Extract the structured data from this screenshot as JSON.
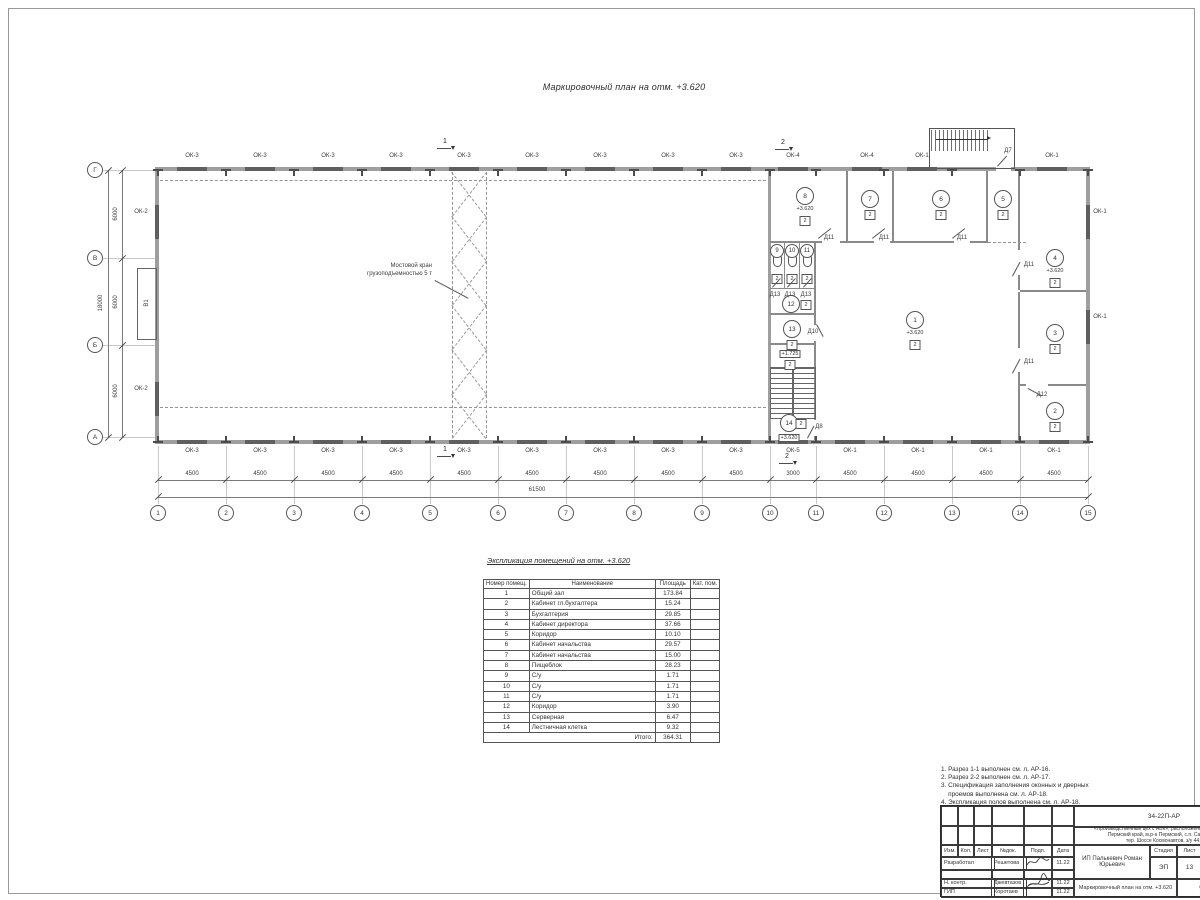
{
  "page_title": "Маркировочный план  на отм. +3.620",
  "plan": {
    "axes_bottom": [
      "1",
      "2",
      "3",
      "4",
      "5",
      "6",
      "7",
      "8",
      "9",
      "10",
      "11",
      "12",
      "13",
      "14",
      "15"
    ],
    "axes_left": [
      "Г",
      "В",
      "Б",
      "А"
    ],
    "dims_bottom": [
      "4500",
      "4500",
      "4500",
      "4500",
      "4500",
      "4500",
      "4500",
      "4500",
      "4500",
      "3000",
      "4500",
      "4500",
      "4500",
      "4500"
    ],
    "dim_bottom_total": "61500",
    "dims_left": [
      "6000",
      "6000",
      "6000"
    ],
    "dim_left_total": "18000",
    "windows_top": [
      "ОК-3",
      "ОК-3",
      "ОК-3",
      "ОК-3",
      "ОК-3",
      "ОК-3",
      "ОК-3",
      "ОК-3",
      "ОК-3",
      "ОК-4",
      "ОК-4",
      "ОК-1",
      "ОК-1"
    ],
    "windows_bottom": [
      "ОК-3",
      "ОК-3",
      "ОК-3",
      "ОК-3",
      "ОК-3",
      "ОК-3",
      "ОК-3",
      "ОК-3",
      "ОК-3",
      "ОК-5",
      "ОК-1",
      "ОК-1",
      "ОК-1",
      "ОК-1"
    ],
    "windows_left": [
      "ОК-2",
      "ОК-2"
    ],
    "windows_right": [
      "ОК-1",
      "ОК-1"
    ],
    "gate_label": "В1",
    "crane_note_line1": "Мостовой кран",
    "crane_note_line2": "грузоподъемностью 5 т",
    "section_marks": [
      "1",
      "2",
      "1",
      "2"
    ],
    "rooms": [
      {
        "num": "8",
        "level": "+3.620",
        "kat": "2"
      },
      {
        "num": "7",
        "kat": "2"
      },
      {
        "num": "6",
        "kat": "2"
      },
      {
        "num": "5",
        "kat": "2"
      },
      {
        "num": "4",
        "level": "+3.620",
        "kat": "2"
      },
      {
        "num": "9"
      },
      {
        "num": "10"
      },
      {
        "num": "11"
      },
      {
        "num": "12",
        "kat": "2"
      },
      {
        "num": "13",
        "kat": "2"
      },
      {
        "num": "1",
        "level": "+3.620",
        "kat": "2"
      },
      {
        "num": "3",
        "kat": "2"
      },
      {
        "num": "2",
        "kat": "2"
      },
      {
        "num": "14",
        "kat": "2",
        "level_boxed": "+3.620"
      }
    ],
    "wc_kats": [
      "2",
      "2",
      "2"
    ],
    "landing_level_boxed": "+1.725",
    "landing_kat": "2",
    "doors": [
      "Д11",
      "Д11",
      "Д11",
      "Д11",
      "Д11",
      "Д12",
      "Д13",
      "Д13",
      "Д13",
      "Д10",
      "Д8",
      "Д7"
    ]
  },
  "explication": {
    "title": "Экспликация помещений на отм. +3.620",
    "headers": {
      "num": "Номер помещ.",
      "name": "Наименование",
      "area": "Площадь",
      "kat": "Кат. пом."
    },
    "rows": [
      {
        "num": "1",
        "name": "Общий зал",
        "area": "173.84"
      },
      {
        "num": "2",
        "name": "Кабинет гл.бухгалтера",
        "area": "15.24"
      },
      {
        "num": "3",
        "name": "Бухгалтерия",
        "area": "29.85"
      },
      {
        "num": "4",
        "name": "Кабинет директора",
        "area": "37.66"
      },
      {
        "num": "5",
        "name": "Коридор",
        "area": "10.10"
      },
      {
        "num": "6",
        "name": "Кабинет начальства",
        "area": "29.57"
      },
      {
        "num": "7",
        "name": "Кабинет начальства",
        "area": "15.00"
      },
      {
        "num": "8",
        "name": "Пищеблок",
        "area": "28.23"
      },
      {
        "num": "9",
        "name": "С/у",
        "area": "1.71"
      },
      {
        "num": "10",
        "name": "С/у",
        "area": "1.71"
      },
      {
        "num": "11",
        "name": "С/у",
        "area": "1.71"
      },
      {
        "num": "12",
        "name": "Коридор",
        "area": "3.90"
      },
      {
        "num": "13",
        "name": "Серверная",
        "area": "6.47"
      },
      {
        "num": "14",
        "name": "Лестничная клетка",
        "area": "9.32"
      }
    ],
    "total_label": "Итого:",
    "total": "364.31"
  },
  "notes": [
    "1. Разрез 1-1 выполнен см. л. АР-16.",
    "2. Разрез 2-2 выполнен см. л. АР-17.",
    "3. Спецификация заполнения оконных и дверных",
    "    проемов выполнена см. л. АР-18.",
    "4. Экспликация полов выполнена см. л. АР-18."
  ],
  "titleblock": {
    "doc_number": "34-22П-АР",
    "project_line1": "«Производственный цех с АБК», расположенный по адресу:",
    "project_line2": "Пермский край, м.р-н Пермский, с.п. Савинское,",
    "project_line3": "тер. Шоссе Космонавтов, з/у 441",
    "cols": [
      "Изм.",
      "Кол.",
      "Лист",
      "№док.",
      "Подп.",
      "Дата"
    ],
    "rows": [
      {
        "role": "Разработал",
        "name": "Решетова",
        "date": "11.22"
      },
      {
        "role": "Н. контр.",
        "name": "Джевтазов",
        "date": "11.22"
      },
      {
        "role": "ГИП",
        "name": "Коротаев",
        "date": "11.22"
      }
    ],
    "client": "ИП Палькевич Роман Юрьевич",
    "stage_label": "Стадия",
    "sheet_label": "Лист",
    "stage": "ЭП",
    "sheet": "13",
    "drawing_title": "Маркировочный план на отм. +3.620",
    "company": "ООО \"Альм"
  }
}
